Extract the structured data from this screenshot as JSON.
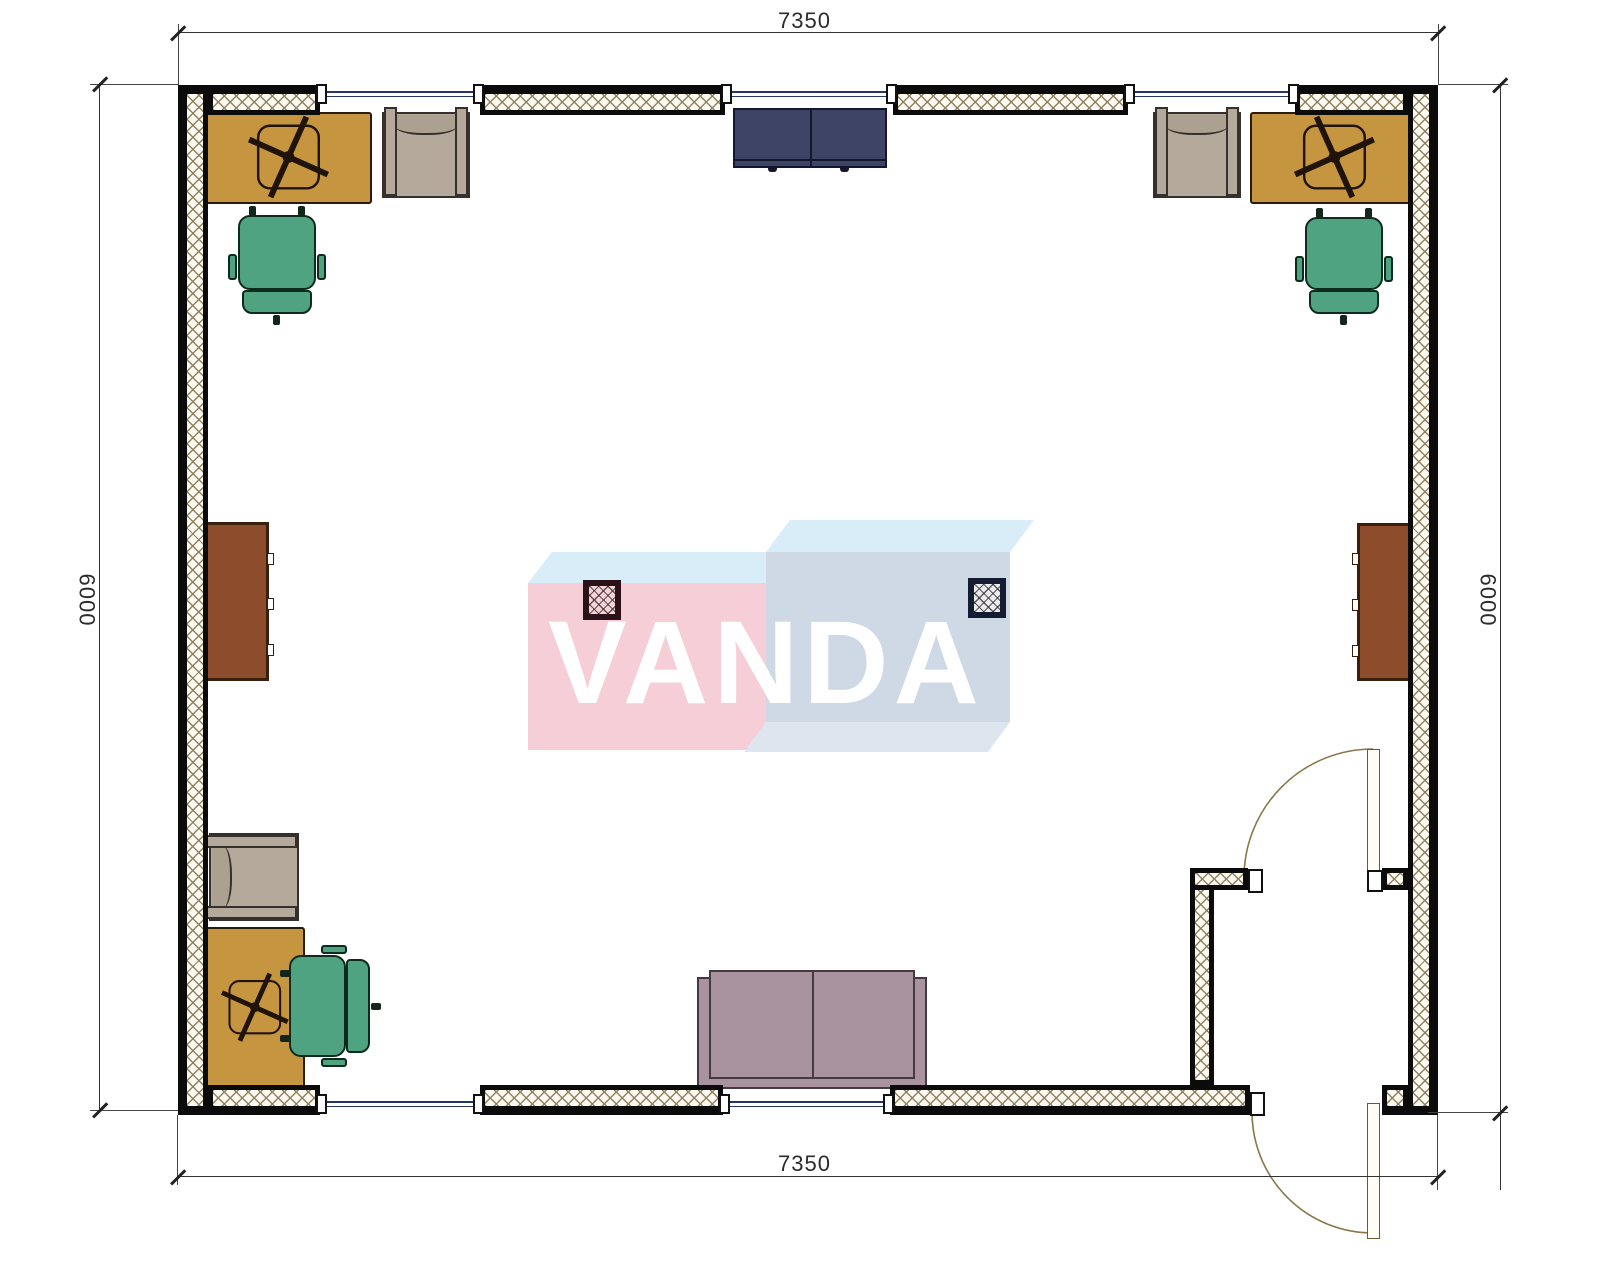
{
  "document": {
    "kind": "architectural floor plan, top view, single room with entry vestibule",
    "watermark": "VANDA"
  },
  "dimension_labels": {
    "top": "7350",
    "bottom": "7350",
    "left": "6000",
    "right": "6000"
  },
  "plan": {
    "exterior_windows_top": 3,
    "exterior_windows_bottom": 2,
    "doors": 2,
    "columns": 2
  },
  "furniture": [
    {
      "item": "desk-with-task-chair-cross-base",
      "count": 3,
      "color": "#c6953f"
    },
    {
      "item": "office-chair",
      "count": 3,
      "color": "#4fa381"
    },
    {
      "item": "armchair",
      "count": 3,
      "color": "#b5a99c"
    },
    {
      "item": "tall-side-cabinet",
      "count": 2,
      "color": "#8d4c2b"
    },
    {
      "item": "low-cabinet",
      "count": 1,
      "color": "#3e4466"
    },
    {
      "item": "two-seat-sofa",
      "count": 1,
      "color": "#a8939e"
    }
  ],
  "colors": {
    "wall_hatch": "#8d7c5a",
    "window_glass": "#26356b",
    "dimension_lines": "#333333",
    "logo_pink_front": "#f6ced8",
    "logo_blue_front": "#cfd9e6",
    "logo_sky_top": "#d9edf8"
  }
}
